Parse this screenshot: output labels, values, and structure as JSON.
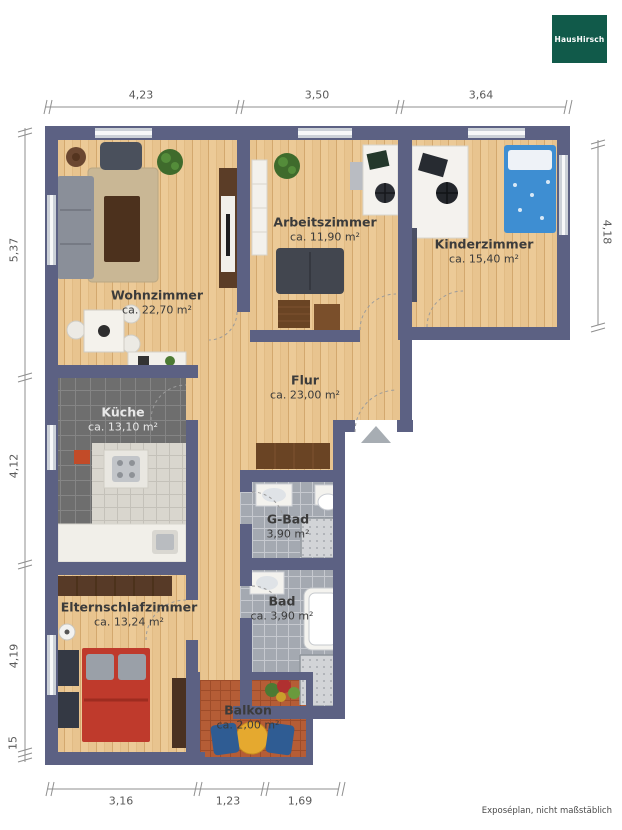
{
  "logo": {
    "text": "HausHirsch"
  },
  "footnote": "Exposéplan, nicht maßstäblich",
  "dimensions": {
    "top": [
      "4,23",
      "3,50",
      "3,64"
    ],
    "left": [
      "5,37",
      "4,12",
      "4,19",
      "15"
    ],
    "right": [
      "4,18"
    ],
    "bottom": [
      "3,16",
      "1,23",
      "1,69"
    ]
  },
  "rooms": {
    "wohnzimmer": {
      "name": "Wohnzimmer",
      "area": "ca. 22,70 m²"
    },
    "arbeitszimmer": {
      "name": "Arbeitszimmer",
      "area": "ca. 11,90 m²"
    },
    "kinderzimmer": {
      "name": "Kinderzimmer",
      "area": "ca. 15,40 m²"
    },
    "flur": {
      "name": "Flur",
      "area": "ca. 23,00 m²"
    },
    "kueche": {
      "name": "Küche",
      "area": "ca. 13,10 m²"
    },
    "gbad": {
      "name": "G-Bad",
      "area": "3,90 m²"
    },
    "bad": {
      "name": "Bad",
      "area": "ca. 3,90 m²"
    },
    "elternschlafzimmer": {
      "name": "Elternschlafzimmer",
      "area": "ca. 13,24 m²"
    },
    "balkon": {
      "name": "Balkon",
      "area": "ca. 2,00 m²"
    }
  },
  "markers": {
    "entrance_arrow": "triangle-up"
  },
  "colors": {
    "wall": "#5c6183",
    "wood_floor": "#e8c48f",
    "kitchen_tile": "#6e6e6e",
    "bath_tile": "#a4a9b1",
    "balcony_deck": "#b55d36",
    "logo_green": "#115a4a"
  }
}
